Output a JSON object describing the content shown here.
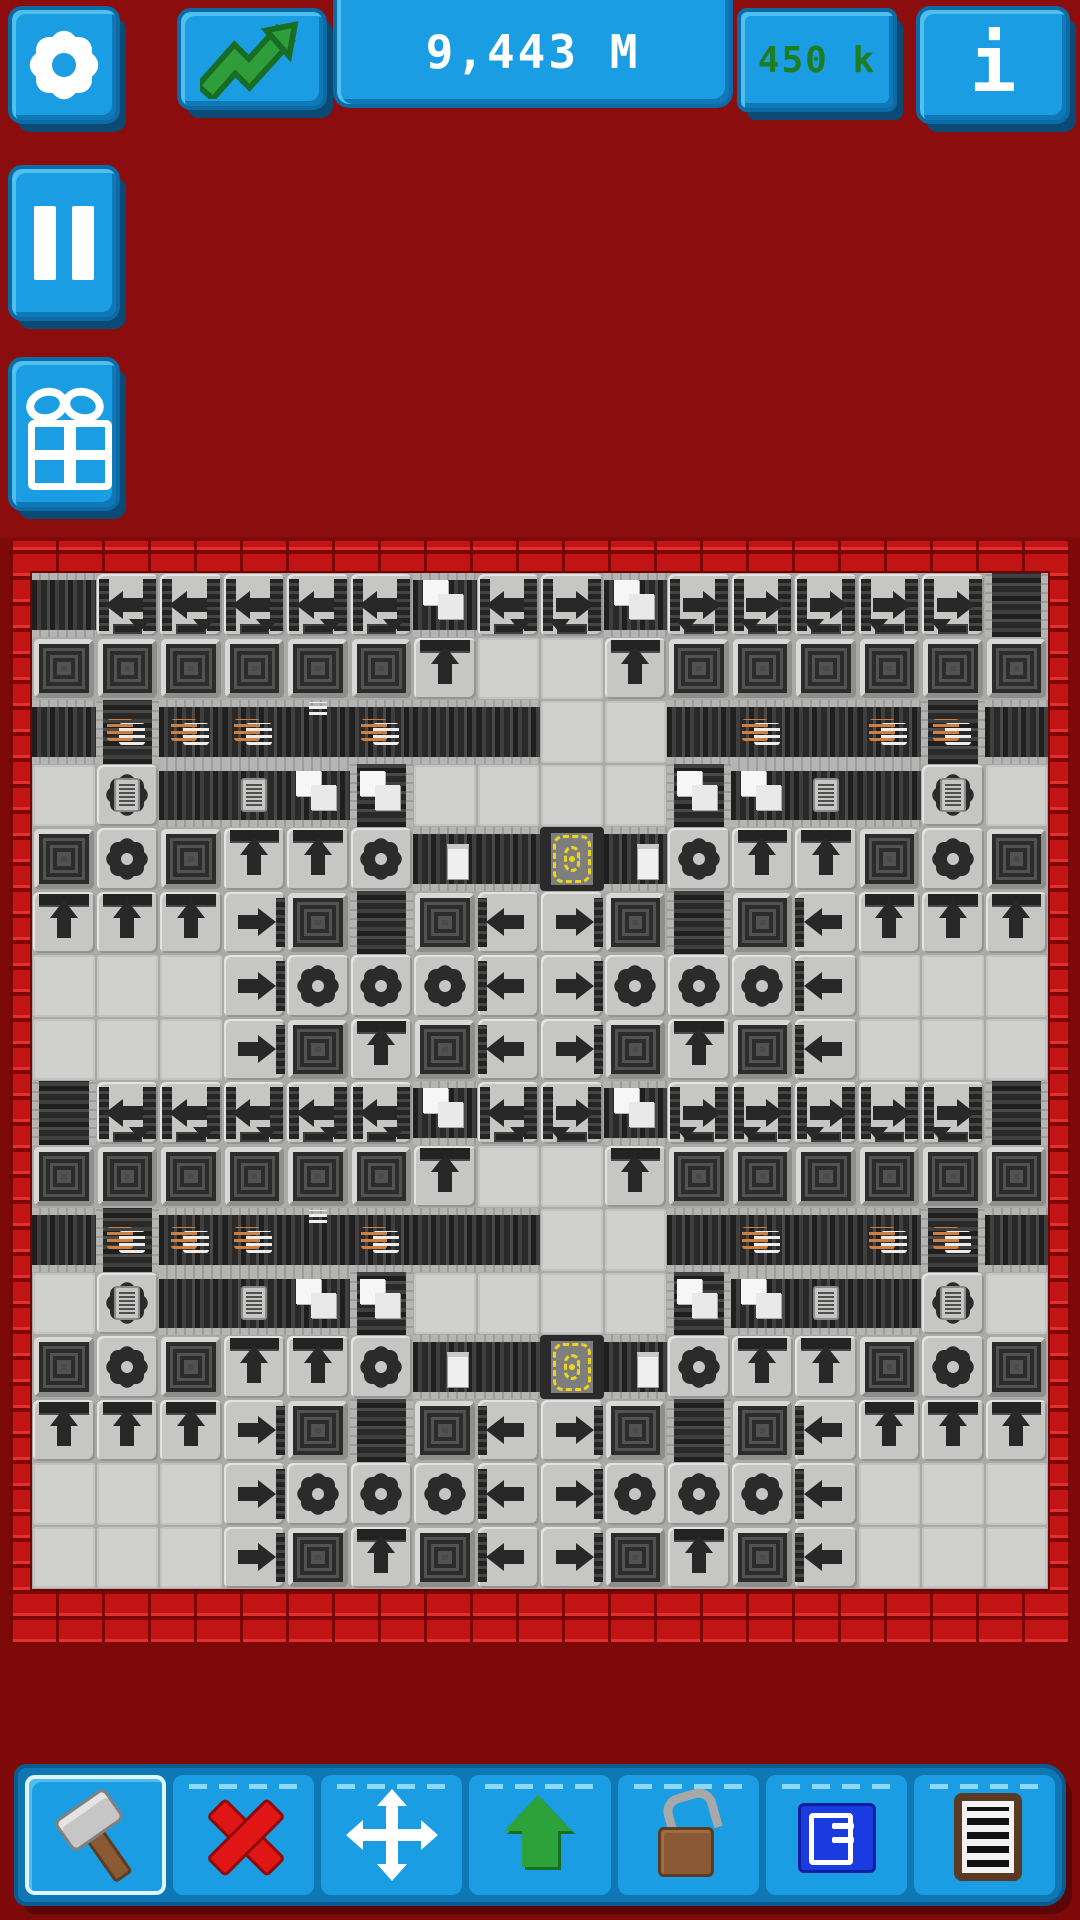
{
  "colors": {
    "background_top": "#8b0d0d",
    "background_bottom": "#7e0909",
    "brick_face": "#c21414",
    "brick_highlight": "#e03030",
    "brick_mortar": "#7d0606",
    "button_blue": "#1a9de2",
    "button_blue_dark": "#0c6ba6",
    "button_blue_light": "#4fc0ee",
    "money_text": "#ffffff",
    "income_text": "#1d7d20",
    "trend_green": "#2f9e3a",
    "floor_seam": "#aaaaa8",
    "tile_light": "#c6c6c4",
    "tile_empty": "#d0d0ce",
    "belt_dark": "#262626",
    "machine_dark": "#2c2c2c",
    "starter_yellow": "#ecd51c",
    "coil_orange": "#cf8040",
    "coil_white": "#ececec",
    "delete_red": "#e01616",
    "upgrade_green": "#2ca23b",
    "lock_brown": "#8a5a36",
    "blueprint_blue": "#1a3be0"
  },
  "topbar": {
    "money": "9,443 M",
    "income_rate": "450 k",
    "info_label": "i"
  },
  "factory": {
    "grid_cols": 16,
    "grid_rows": 16,
    "tile_legend": {
      "mt": "empty floor",
      "bh": "conveyor belt horizontal",
      "bv": "conveyor belt vertical",
      "ds": "container crate",
      "g": "crafter gear machine",
      "up": "roller arrow up",
      "al": "roller arrow left",
      "ar": "roller arrow right",
      "alh": "turn arrow left-down",
      "arh": "turn arrow right-down",
      "st": "starter with yellow dashed coil",
      ".p": "white papers on belt",
      ".c": "chip device",
      ".w": "wire coils orange-white",
      ".s": "small wire strand",
      ".i": "single white item"
    },
    "grid": [
      [
        "bh",
        "alh",
        "alh",
        "alh",
        "alh",
        "alh",
        "bh.p",
        "alh",
        "arh",
        "bh.p",
        "arh",
        "arh",
        "arh",
        "arh",
        "arh",
        "bv"
      ],
      [
        "ds",
        "ds",
        "ds",
        "ds",
        "ds",
        "ds",
        "up",
        "mt",
        "mt",
        "up",
        "ds",
        "ds",
        "ds",
        "ds",
        "ds",
        "ds"
      ],
      [
        "bh",
        "bv.w",
        "bh.w",
        "bh.w",
        "bh.s",
        "bh.w",
        "bh",
        "bh",
        "mt",
        "mt",
        "bh",
        "bh.w",
        "bh",
        "bh.w",
        "bv.w",
        "bh"
      ],
      [
        "mt",
        "g.c",
        "bh",
        "bh.c",
        "bh.p",
        "bv.p",
        "mt",
        "mt",
        "mt",
        "mt",
        "bv.p",
        "bh.p",
        "bh.c",
        "bh",
        "g.c",
        "mt"
      ],
      [
        "ds",
        "g",
        "ds",
        "up",
        "up",
        "g",
        "bh.i",
        "bh",
        "st",
        "bh.i",
        "g",
        "up",
        "up",
        "ds",
        "g",
        "ds"
      ],
      [
        "up",
        "up",
        "up",
        "ar",
        "ds",
        "bv",
        "ds",
        "al",
        "ar",
        "ds",
        "bv",
        "ds",
        "al",
        "up",
        "up",
        "up"
      ],
      [
        "mt",
        "mt",
        "mt",
        "ar",
        "g",
        "g",
        "g",
        "al",
        "ar",
        "g",
        "g",
        "g",
        "al",
        "mt",
        "mt",
        "mt"
      ],
      [
        "mt",
        "mt",
        "mt",
        "ar",
        "ds",
        "up",
        "ds",
        "al",
        "ar",
        "ds",
        "up",
        "ds",
        "al",
        "mt",
        "mt",
        "mt"
      ],
      [
        "bv",
        "alh",
        "alh",
        "alh",
        "alh",
        "alh",
        "bh.p",
        "alh",
        "arh",
        "bh.p",
        "arh",
        "arh",
        "arh",
        "arh",
        "arh",
        "bv"
      ],
      [
        "ds",
        "ds",
        "ds",
        "ds",
        "ds",
        "ds",
        "up",
        "mt",
        "mt",
        "up",
        "ds",
        "ds",
        "ds",
        "ds",
        "ds",
        "ds"
      ],
      [
        "bh",
        "bv.w",
        "bh.w",
        "bh.w",
        "bh.s",
        "bh.w",
        "bh",
        "bh",
        "mt",
        "mt",
        "bh",
        "bh.w",
        "bh",
        "bh.w",
        "bv.w",
        "bh"
      ],
      [
        "mt",
        "g.c",
        "bh",
        "bh.c",
        "bh.p",
        "bv.p",
        "mt",
        "mt",
        "mt",
        "mt",
        "bv.p",
        "bh.p",
        "bh.c",
        "bh",
        "g.c",
        "mt"
      ],
      [
        "ds",
        "g",
        "ds",
        "up",
        "up",
        "g",
        "bh.i",
        "bh",
        "st",
        "bh.i",
        "g",
        "up",
        "up",
        "ds",
        "g",
        "ds"
      ],
      [
        "up",
        "up",
        "up",
        "ar",
        "ds",
        "bv",
        "ds",
        "al",
        "ar",
        "ds",
        "bv",
        "ds",
        "al",
        "up",
        "up",
        "up"
      ],
      [
        "mt",
        "mt",
        "mt",
        "ar",
        "g",
        "g",
        "g",
        "al",
        "ar",
        "g",
        "g",
        "g",
        "al",
        "mt",
        "mt",
        "mt"
      ],
      [
        "mt",
        "mt",
        "mt",
        "ar",
        "ds",
        "up",
        "ds",
        "al",
        "ar",
        "ds",
        "up",
        "ds",
        "al",
        "mt",
        "mt",
        "mt"
      ]
    ]
  },
  "toolbar": {
    "selected": "build",
    "buttons": [
      {
        "id": "build",
        "icon": "hammer-icon"
      },
      {
        "id": "delete",
        "icon": "cross-icon"
      },
      {
        "id": "move",
        "icon": "move-icon"
      },
      {
        "id": "upgrade",
        "icon": "up-arrow-icon"
      },
      {
        "id": "unlock",
        "icon": "open-padlock-icon"
      },
      {
        "id": "blueprint",
        "icon": "blueprint-icon"
      },
      {
        "id": "orders",
        "icon": "clipboard-icon"
      }
    ]
  }
}
